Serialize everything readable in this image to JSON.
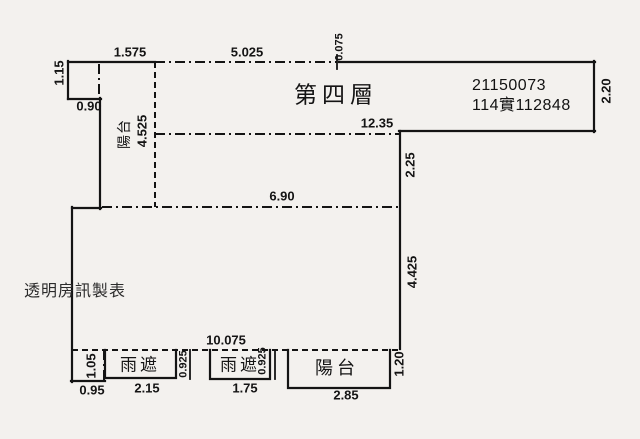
{
  "canvas": {
    "width": 640,
    "height": 439,
    "background": "#f3f1ee",
    "ink": "#141414"
  },
  "plan": {
    "floor_label": "第四層",
    "registry": {
      "serial": "21150073",
      "case_no": "114實112848"
    },
    "watermark": "透明房訊製表",
    "features": {
      "top_balcony": "陽台",
      "canopy_left": "雨遮",
      "canopy_right": "雨遮",
      "bottom_balcony": "陽台"
    },
    "dims": {
      "top_offset": "1.575",
      "top_main": "5.025",
      "top_step": "0.075",
      "notch_height": "1.15",
      "notch_width": "0.90",
      "top_balcony_depth": "4.525",
      "upper_width": "12.35",
      "right_upper": "2.20",
      "right_mid": "2.25",
      "interior_width": "6.90",
      "right_lower": "4.425",
      "bottom_total": "10.075",
      "bottom_notch_height": "1.05",
      "bottom_notch_width": "0.95",
      "canopy_left_width": "2.15",
      "canopy_left_depth": "0.925",
      "canopy_right_width": "1.75",
      "canopy_right_depth": "0.925",
      "bottom_balcony_width": "2.85",
      "bottom_balcony_depth": "1.20"
    }
  }
}
